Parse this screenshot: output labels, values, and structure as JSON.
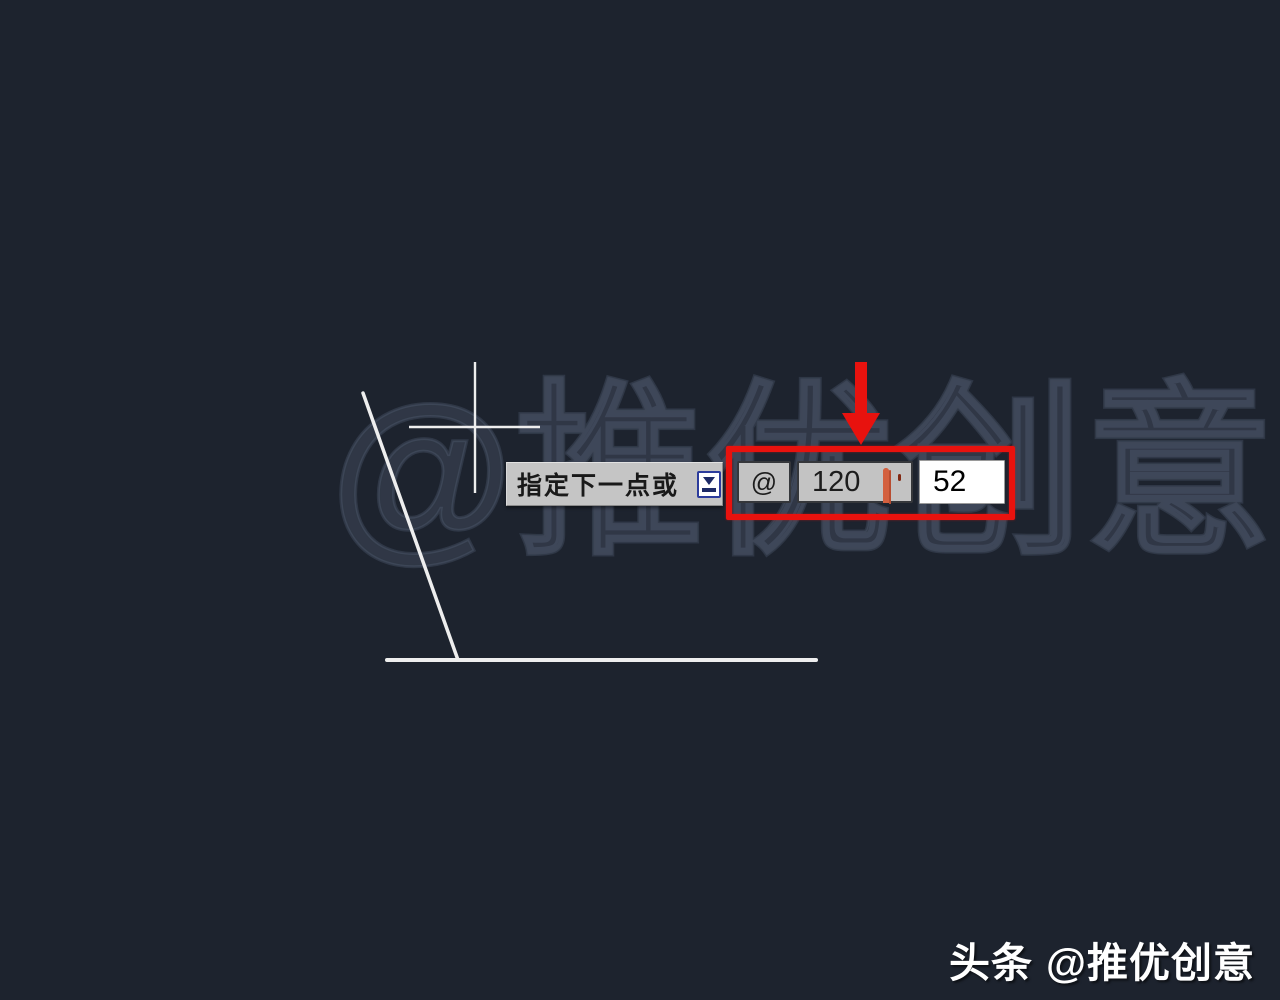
{
  "scene": {
    "background_color": "#1d232e",
    "watermark_text": "@推优创意"
  },
  "dynamic_input": {
    "prompt": "指定下一点或",
    "prefix_symbol": "@",
    "distance_value": "120",
    "angle_value": "52"
  },
  "icons": {
    "dynamic_input_icon": "down-arrow-badge-icon",
    "lock_icon": "padlock-icon"
  },
  "annotations": {
    "highlight_color": "#e8120e",
    "line_color": "#eeeeee"
  },
  "credit": {
    "source": "头条",
    "handle": "@推优创意"
  }
}
